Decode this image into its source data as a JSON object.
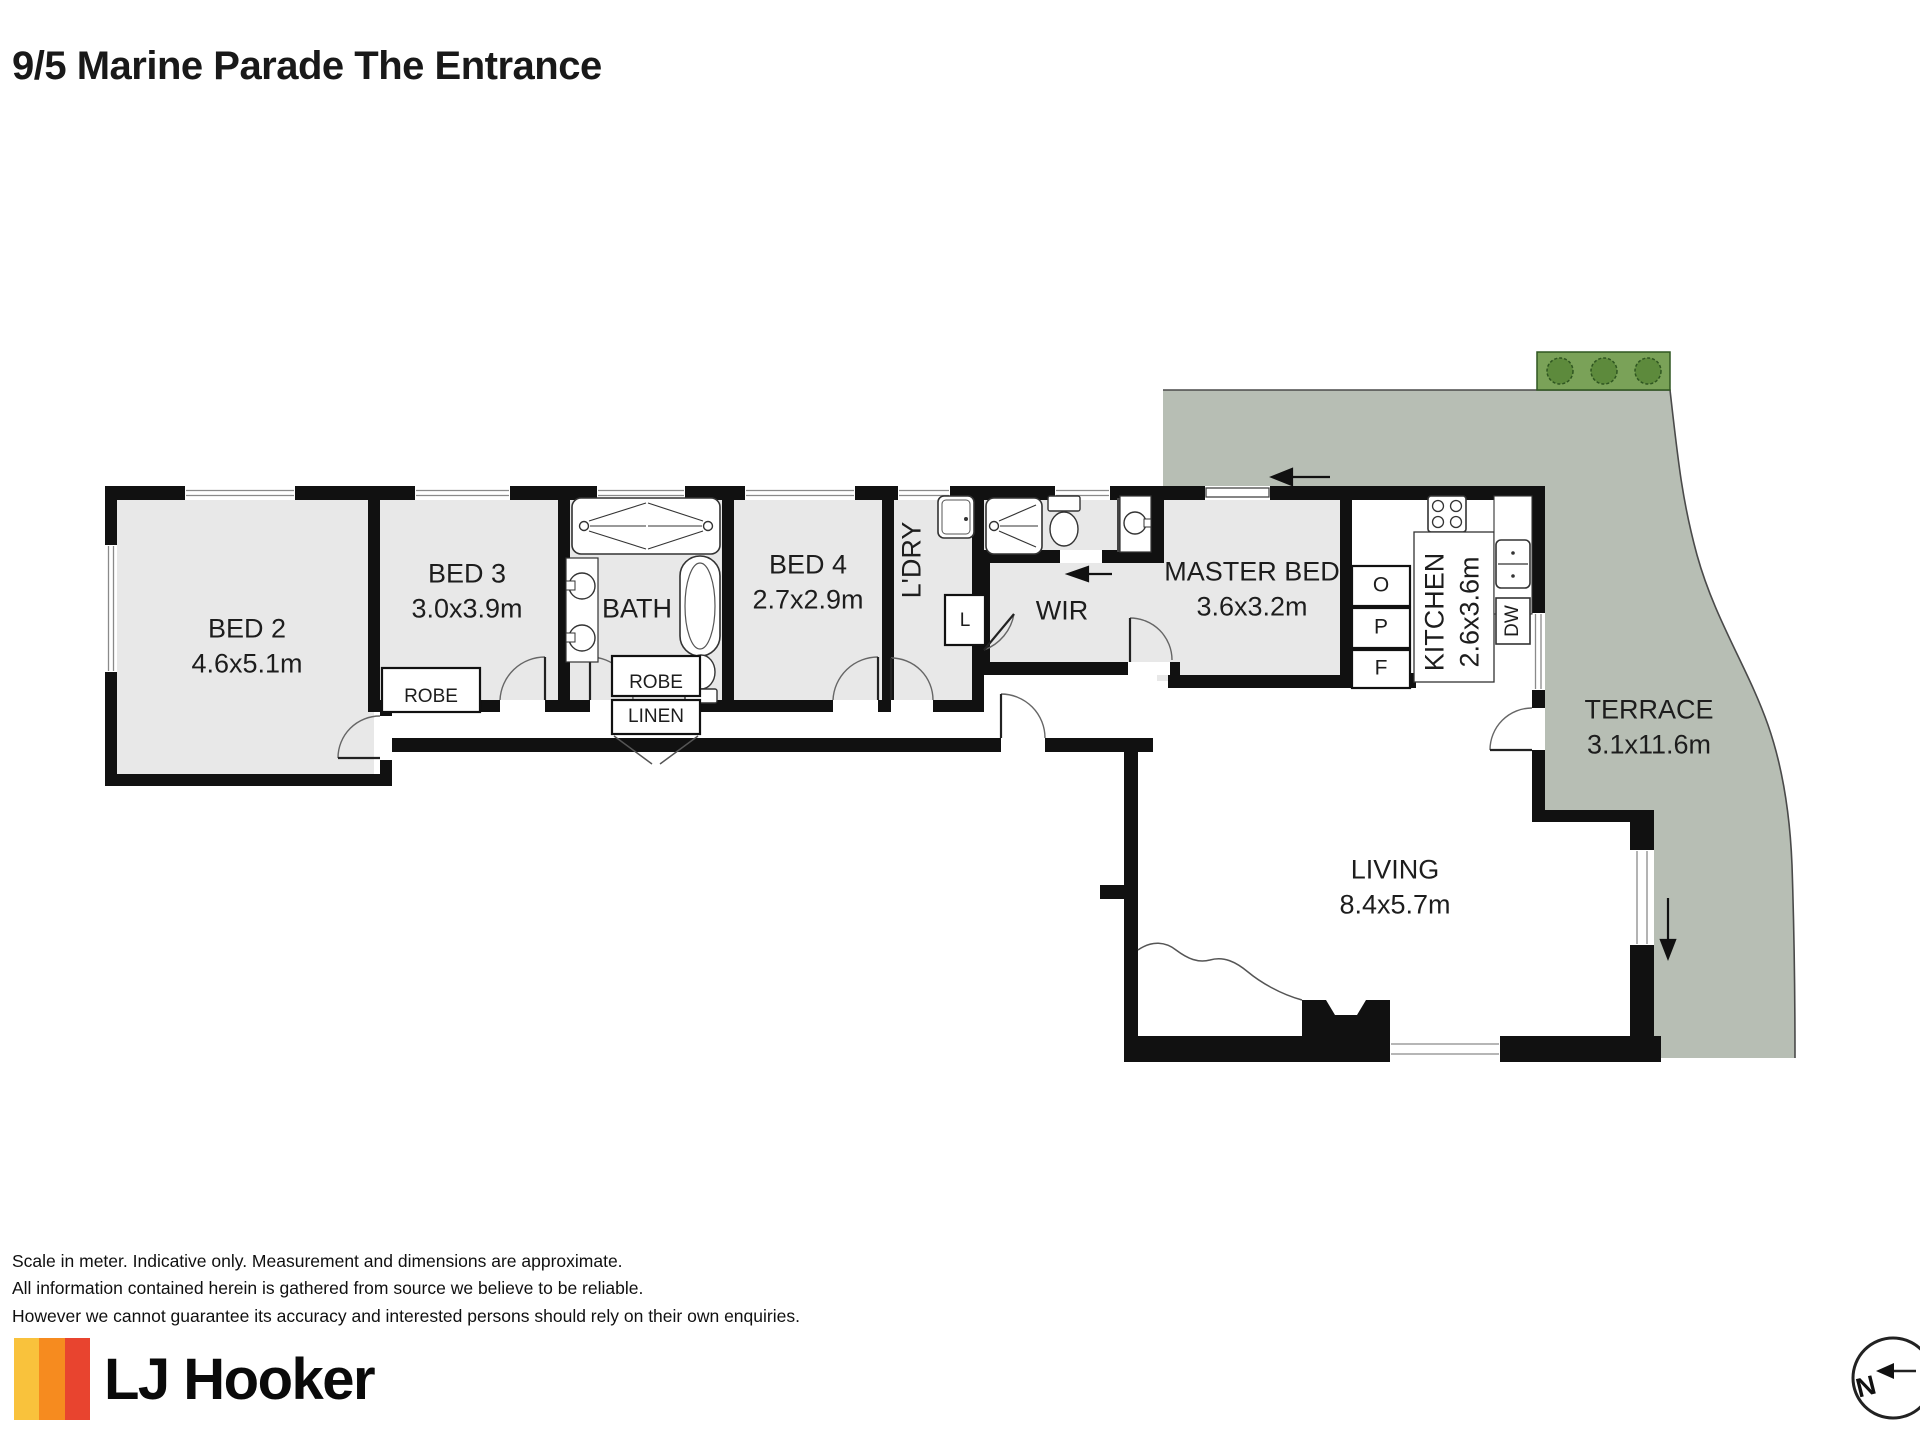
{
  "title": "9/5 Marine Parade The Entrance",
  "colors": {
    "wall": "#111111",
    "room_fill": "#e8e8e8",
    "terrace_fill": "#b7beb4",
    "planter_fill": "#7aa258",
    "planter_bush": "#5d8a3c",
    "accent_yellow": "#f9c23c",
    "accent_orange": "#f68b1f",
    "accent_red": "#e8442f"
  },
  "rooms": {
    "bed2": {
      "name": "BED 2",
      "dims": "4.6x5.1m"
    },
    "bed3": {
      "name": "BED 3",
      "dims": "3.0x3.9m"
    },
    "bath": {
      "name": "BATH"
    },
    "bed4": {
      "name": "BED 4",
      "dims": "2.7x2.9m"
    },
    "laundry": {
      "name": "L'DRY"
    },
    "wir": {
      "name": "WIR"
    },
    "master": {
      "name": "MASTER BED",
      "dims": "3.6x3.2m"
    },
    "kitchen": {
      "name": "KITCHEN",
      "dims": "2.6x3.6m"
    },
    "living": {
      "name": "LIVING",
      "dims": "8.4x5.7m"
    },
    "terrace": {
      "name": "TERRACE",
      "dims": "3.1x11.6m"
    }
  },
  "storage": {
    "robe_bed3": "ROBE",
    "robe_bed4": "ROBE",
    "linen": "LINEN",
    "linen_cupboard": "L"
  },
  "kitchen_items": {
    "oven": "O",
    "pantry": "P",
    "fridge": "F",
    "dishwasher": "DW"
  },
  "compass": {
    "north": "N"
  },
  "footer": {
    "disclaimer": [
      "Scale in meter. Indicative only. Measurement and dimensions are approximate.",
      "All information contained herein is gathered from source we believe to be reliable.",
      "However we cannot guarantee its accuracy and interested persons should rely on their own enquiries."
    ],
    "brand": "LJ Hooker"
  }
}
